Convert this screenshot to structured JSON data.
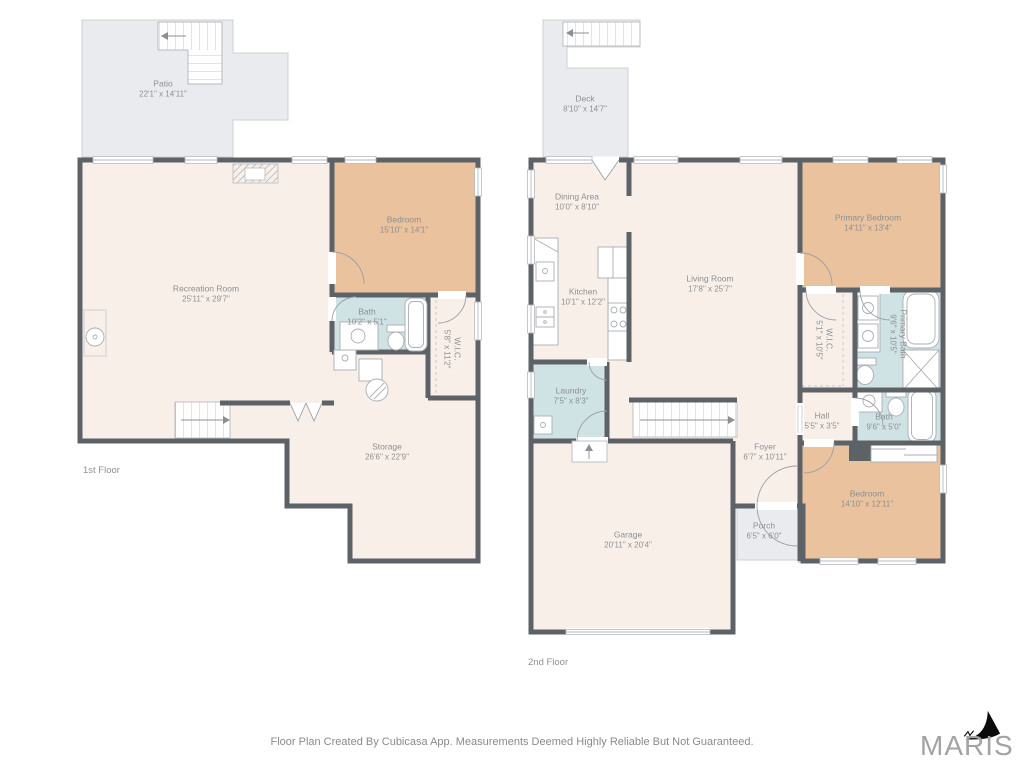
{
  "colors": {
    "wall": "#5d6267",
    "room": "#f8efe9",
    "bedroom": "#eac29d",
    "bath": "#cfe2e4",
    "outdoor": "#e9ebee",
    "outdoor_border": "#cdd0d4",
    "fixture": "#a9aeb4",
    "label": "#8d9094",
    "footer": "#8a8a8a",
    "logo_text": "#a3a3a3",
    "logo_sail": "#0b0b0b"
  },
  "floors": [
    {
      "label": "1st Floor",
      "rooms": [
        {
          "name": "Patio",
          "dims": "22'1\" x 14'11\""
        },
        {
          "name": "Recreation Room",
          "dims": "25'11\" x 29'7\""
        },
        {
          "name": "Bedroom",
          "dims": "15'10\" x 14'1\""
        },
        {
          "name": "Bath",
          "dims": "10'2\" x 5'1\""
        },
        {
          "name": "W.I.C.",
          "dims": "5'8\" x 11'2\""
        },
        {
          "name": "Storage",
          "dims": "26'6\" x 22'9\""
        }
      ]
    },
    {
      "label": "2nd Floor",
      "rooms": [
        {
          "name": "Deck",
          "dims": "8'10\" x 14'7\""
        },
        {
          "name": "Dining Area",
          "dims": "10'0\" x 8'10\""
        },
        {
          "name": "Kitchen",
          "dims": "10'1\" x 12'2\""
        },
        {
          "name": "Living Room",
          "dims": "17'8\" x 25'7\""
        },
        {
          "name": "Laundry",
          "dims": "7'5\" x 8'3\""
        },
        {
          "name": "Primary Bedroom",
          "dims": "14'11\" x 13'4\""
        },
        {
          "name": "W.I.C.",
          "dims": "5'1\" x 10'5\""
        },
        {
          "name": "Primary Bath",
          "dims": "9'6\" x 10'5\""
        },
        {
          "name": "Hall",
          "dims": "5'5\" x 3'5\""
        },
        {
          "name": "Bath",
          "dims": "9'6\" x 5'0\""
        },
        {
          "name": "Foyer",
          "dims": "6'7\" x 10'11\""
        },
        {
          "name": "Porch",
          "dims": "6'5\" x 6'0\""
        },
        {
          "name": "Garage",
          "dims": "20'11\" x 20'4\""
        },
        {
          "name": "Bedroom",
          "dims": "14'10\" x 12'11\""
        }
      ]
    }
  ],
  "footer": {
    "disclaimer": "Floor Plan Created By Cubicasa App. Measurements Deemed Highly Reliable But Not Guaranteed."
  },
  "logo": {
    "text": "MARIS"
  }
}
